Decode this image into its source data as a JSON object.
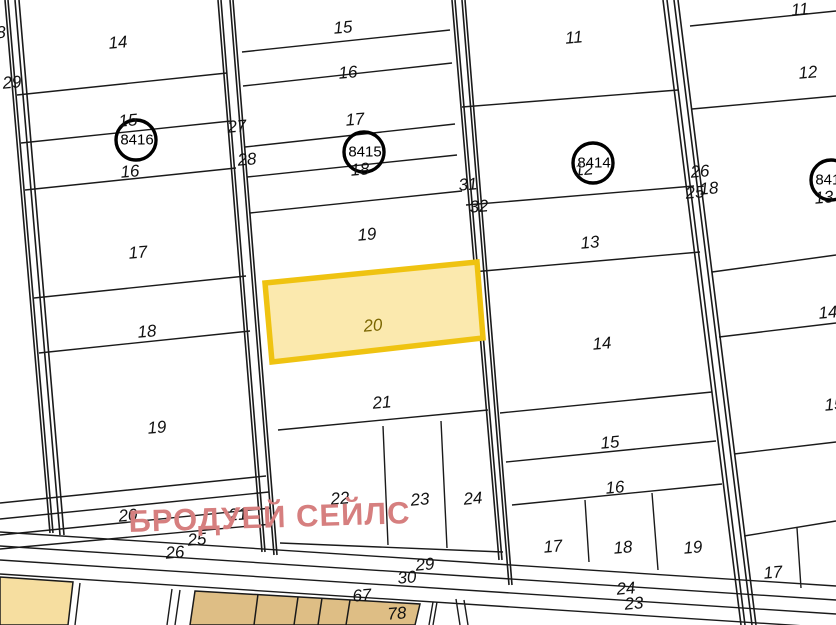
{
  "map": {
    "watermark_text": "БРОДУЕЙ СЕЙЛС",
    "highlighted_parcel": {
      "number": "20"
    },
    "block_circles": [
      {
        "number": "8416"
      },
      {
        "number": "8415"
      },
      {
        "number": "8414"
      },
      {
        "number": "8413"
      }
    ],
    "colors": {
      "highlight_fill": "#FBE9AE",
      "highlight_stroke": "#EFC311",
      "tan_light": "#F6DEA0",
      "tan_dark": "#DEBE85",
      "watermark": "#D67F7F",
      "line": "#1A1A1A"
    },
    "labels": [
      {
        "kind": "edge",
        "text": "8"
      },
      {
        "kind": "edge",
        "text": "29"
      },
      {
        "kind": "parcel",
        "text": "14"
      },
      {
        "kind": "parcel",
        "text": "15"
      },
      {
        "kind": "parcel",
        "text": "16"
      },
      {
        "kind": "edge",
        "text": "27"
      },
      {
        "kind": "edge",
        "text": "28"
      },
      {
        "kind": "parcel",
        "text": "17"
      },
      {
        "kind": "parcel",
        "text": "18"
      },
      {
        "kind": "parcel",
        "text": "19"
      },
      {
        "kind": "edge",
        "text": "20"
      },
      {
        "kind": "edge",
        "text": "21"
      },
      {
        "kind": "edge",
        "text": "25"
      },
      {
        "kind": "edge",
        "text": "26"
      },
      {
        "kind": "parcel",
        "text": "15"
      },
      {
        "kind": "parcel",
        "text": "16"
      },
      {
        "kind": "parcel",
        "text": "17"
      },
      {
        "kind": "parcel",
        "text": "18"
      },
      {
        "kind": "parcel",
        "text": "19"
      },
      {
        "kind": "parcel",
        "text": "21"
      },
      {
        "kind": "edge",
        "text": "31"
      },
      {
        "kind": "edge",
        "text": "32"
      },
      {
        "kind": "parcel",
        "text": "22"
      },
      {
        "kind": "parcel",
        "text": "23"
      },
      {
        "kind": "parcel",
        "text": "24"
      },
      {
        "kind": "edge",
        "text": "29"
      },
      {
        "kind": "edge",
        "text": "30"
      },
      {
        "kind": "edge",
        "text": "67"
      },
      {
        "kind": "edge",
        "text": "78"
      },
      {
        "kind": "parcel",
        "text": "11"
      },
      {
        "kind": "parcel",
        "text": "12"
      },
      {
        "kind": "parcel",
        "text": "13"
      },
      {
        "kind": "parcel",
        "text": "14"
      },
      {
        "kind": "parcel",
        "text": "15"
      },
      {
        "kind": "parcel",
        "text": "16"
      },
      {
        "kind": "parcel",
        "text": "17"
      },
      {
        "kind": "parcel",
        "text": "18"
      },
      {
        "kind": "parcel",
        "text": "19"
      },
      {
        "kind": "edge",
        "text": "24"
      },
      {
        "kind": "edge",
        "text": "23"
      },
      {
        "kind": "edge",
        "text": "26"
      },
      {
        "kind": "edge",
        "text": "25"
      },
      {
        "kind": "edge",
        "text": "18"
      },
      {
        "kind": "parcel",
        "text": "11"
      },
      {
        "kind": "parcel",
        "text": "12"
      },
      {
        "kind": "parcel",
        "text": "13"
      },
      {
        "kind": "parcel",
        "text": "14"
      },
      {
        "kind": "parcel",
        "text": "15"
      },
      {
        "kind": "parcel",
        "text": "17"
      }
    ]
  }
}
